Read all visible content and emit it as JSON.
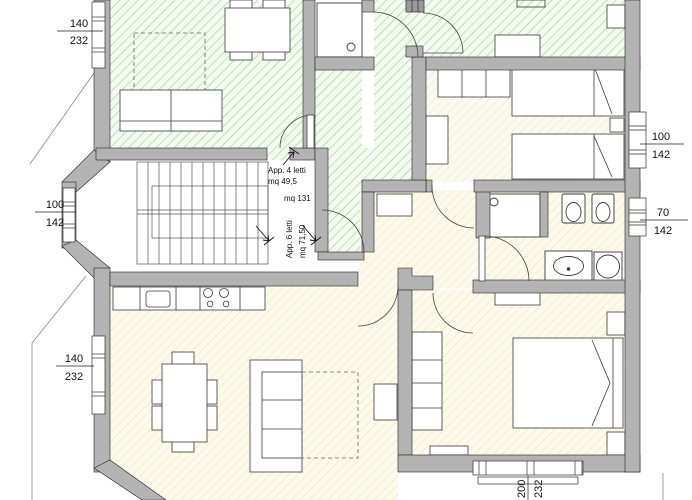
{
  "plan": {
    "annotations": {
      "apt4_line1": "App. 4 letti",
      "apt4_line2": "mq 49,5",
      "total_area": "mq 131",
      "apt6_line1": "App. 6 letti",
      "apt6_line2": "mq 71,50"
    },
    "dimensions": {
      "win_top_left": {
        "w": "140",
        "h": "232"
      },
      "win_stair_bay": {
        "w": "100",
        "h": "142"
      },
      "win_living_left": {
        "w": "140",
        "h": "232"
      },
      "win_bedroom_right": {
        "w": "100",
        "h": "142"
      },
      "win_bath_right": {
        "w": "70",
        "h": "142"
      },
      "win_bedroom_bottom": {
        "w": "200",
        "h": "232"
      }
    },
    "colors": {
      "wall": "#b3b3b3",
      "apt4_hatch": "#92cb8c",
      "apt6_hatch": "#eee4bd"
    }
  }
}
